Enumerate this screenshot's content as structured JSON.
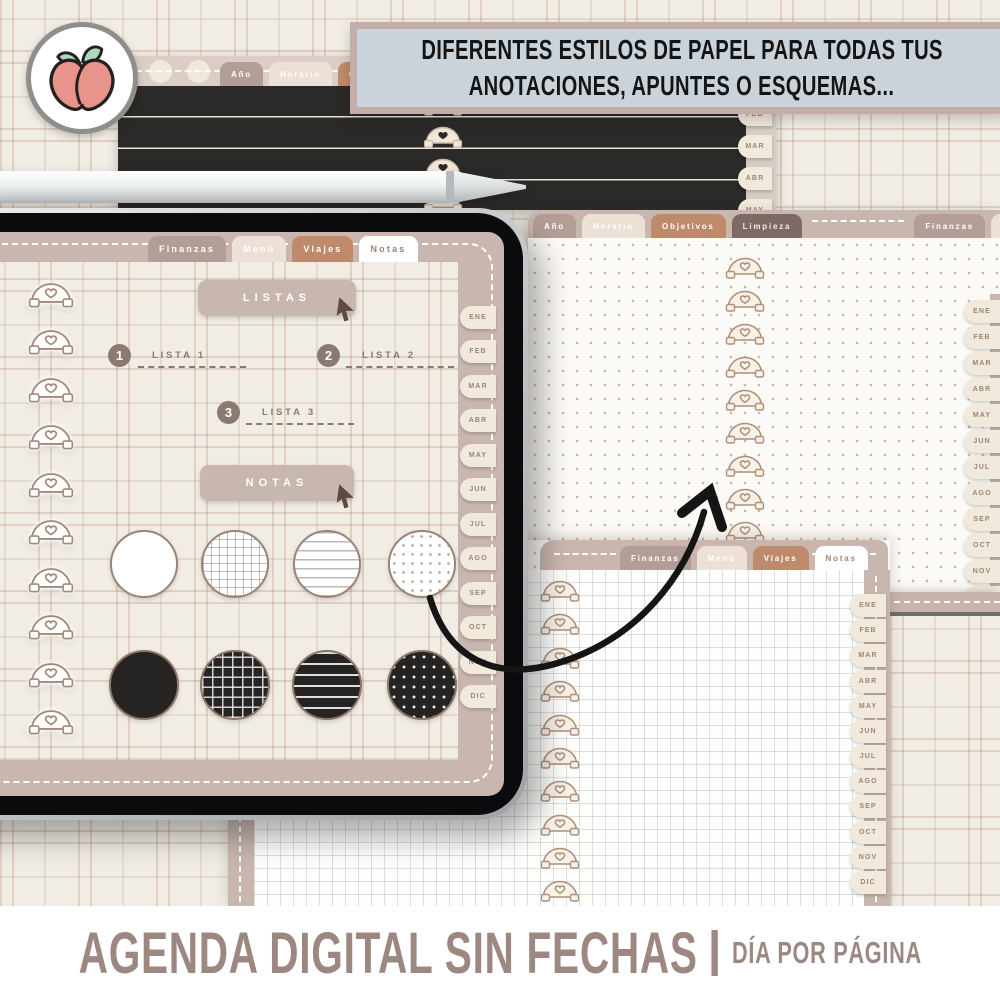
{
  "banner": {
    "line1": "DIFERENTES ESTILOS DE PAPEL PARA TODAS TUS",
    "line2": "ANOTACIONES, APUNTES O ESQUEMAS..."
  },
  "footer": {
    "title": "AGENDA DIGITAL SIN FECHAS",
    "separator": "|",
    "subtitle": "DÍA POR PÁGINA"
  },
  "months": [
    "ENE",
    "FEB",
    "MAR",
    "ABR",
    "MAY",
    "JUN",
    "JUL",
    "AGO",
    "SEP",
    "OCT",
    "NOV",
    "DIC"
  ],
  "dark_page": {
    "tabs": [
      {
        "label": "Año",
        "variant": "taupe"
      },
      {
        "label": "Horario",
        "variant": "light"
      },
      {
        "label": "Objetivos",
        "variant": "terra"
      }
    ]
  },
  "right_page": {
    "paper": "dotted",
    "tabs": [
      {
        "label": "Año",
        "variant": "taupe"
      },
      {
        "label": "Horario",
        "variant": "light"
      },
      {
        "label": "Objetivos",
        "variant": "terra"
      },
      {
        "label": "Limpieza",
        "variant": "dark"
      },
      {
        "label": "Finanzas",
        "variant": "taupe"
      },
      {
        "label": "Menú",
        "variant": "light"
      },
      {
        "label": "Viajes",
        "variant": "terra"
      },
      {
        "label": "Notas",
        "variant": "active"
      }
    ],
    "active_tab": "Notas"
  },
  "tablet_page": {
    "tabs": [
      {
        "label": "Finanzas",
        "variant": "taupe"
      },
      {
        "label": "Menú",
        "variant": "light"
      },
      {
        "label": "Viajes",
        "variant": "terra"
      },
      {
        "label": "Notas",
        "variant": "active"
      }
    ],
    "active_tab": "Notas",
    "listas_button": "LISTAS",
    "notas_button": "NOTAS",
    "lists": [
      {
        "num": "1",
        "label": "LISTA 1"
      },
      {
        "num": "2",
        "label": "LISTA 2"
      },
      {
        "num": "3",
        "label": "LISTA 3"
      }
    ],
    "paper_styles": [
      "blank",
      "grid",
      "lined",
      "dotted"
    ]
  },
  "bottom_page": {
    "paper": "grid",
    "tabs": [
      {
        "label": "Finanzas",
        "variant": "taupe"
      },
      {
        "label": "Menú",
        "variant": "light"
      },
      {
        "label": "Viajes",
        "variant": "terra"
      },
      {
        "label": "Notas",
        "variant": "active"
      }
    ],
    "active_tab": "Notas"
  },
  "colors": {
    "banner_bg": "#CBD3DA",
    "banner_frame": "#C3ADA8",
    "footer_text": "#9C8880",
    "tab_taupe": "#B29E96",
    "tab_light": "#ECE0D7",
    "tab_terra": "#BF8A6B",
    "tab_dark": "#7D6A66",
    "page_band": "#C9B7AF",
    "dark_paper": "#2B2A28",
    "peach_body": "#E8938C",
    "peach_leaf": "#ABD9BE"
  }
}
